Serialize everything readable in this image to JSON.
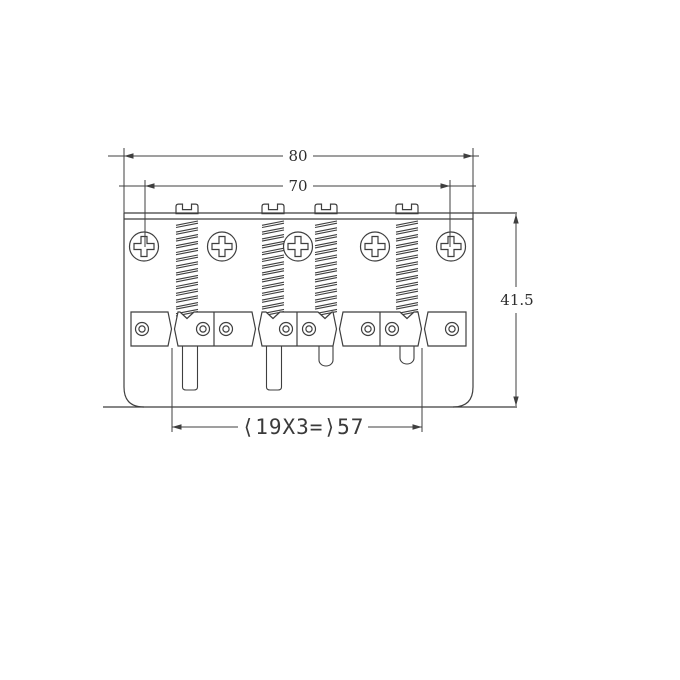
{
  "drawing": {
    "title_hint": "bass-bridge-technical-drawing",
    "line_color": "#3f3f3f",
    "background_color": "#ffffff",
    "dimensions": {
      "overall_width_label": "80",
      "mount_screw_spacing_label": "70",
      "overall_depth_label": "41.5",
      "string_spacing_label": "⟨19X3=⟩57"
    }
  }
}
